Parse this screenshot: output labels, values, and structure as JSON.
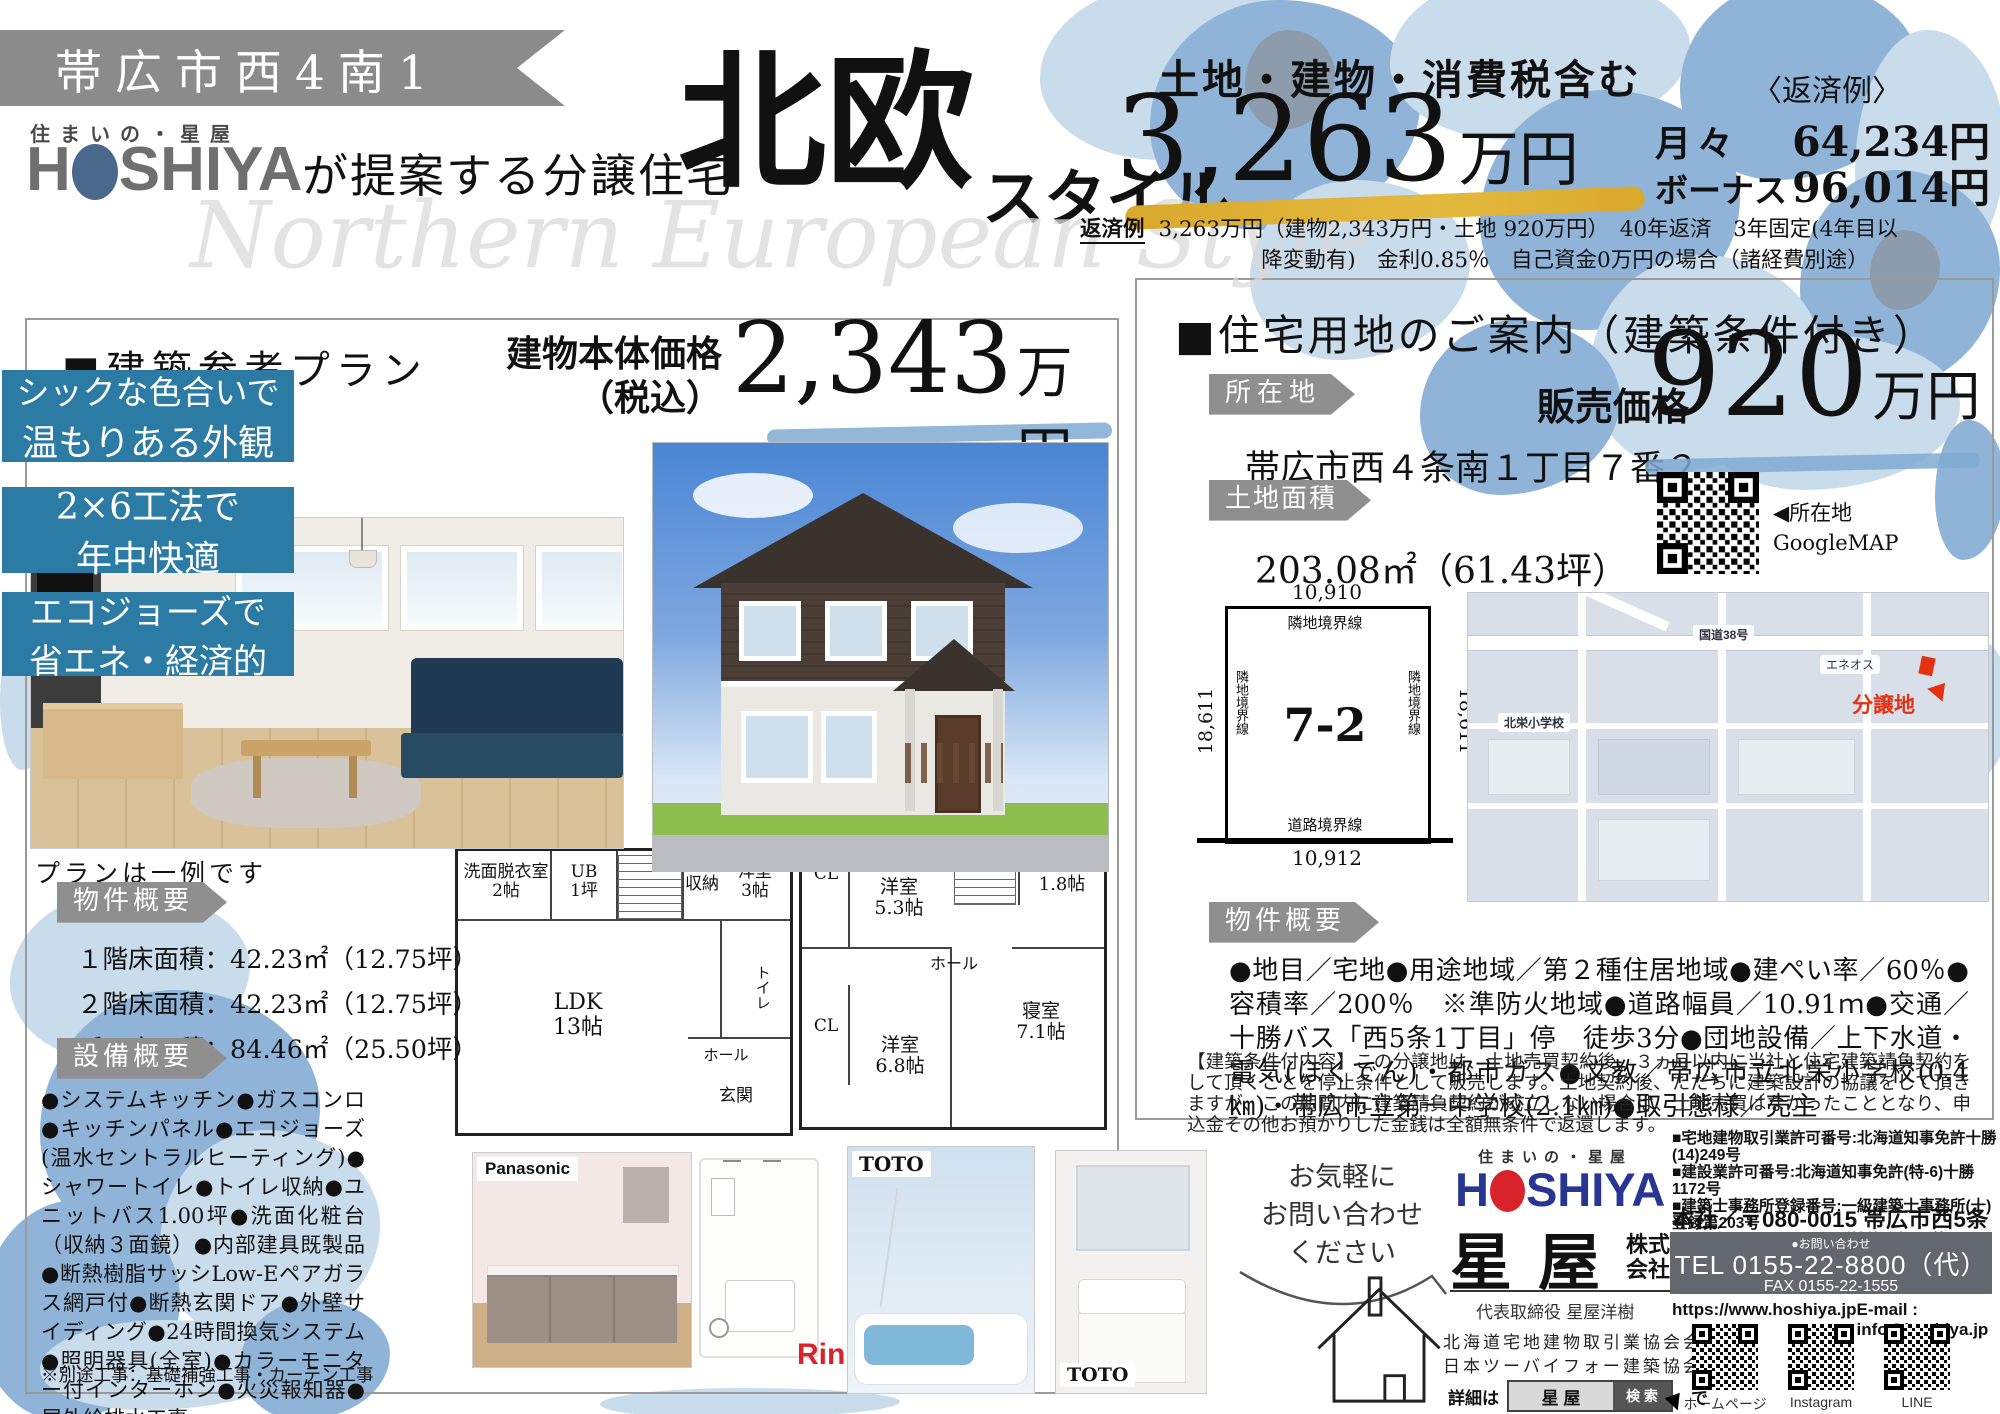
{
  "page": {
    "watermark": "Northern European Style"
  },
  "header": {
    "location_banner": "帯広市西4南1",
    "brand_small": "住まいの・星屋",
    "logo_h": "H",
    "logo_rest": "SHIYA",
    "tagline": "が提案する分譲住宅",
    "style_main": "北欧",
    "style_sub": "スタイル",
    "tax_note": "土地・建物・消費税含む",
    "total_price": "3,263",
    "total_price_unit": "万円",
    "repayment_title": "〈返済例〉",
    "monthly_label": "月々",
    "monthly_value": "64,234円",
    "bonus_label": "ボーナス",
    "bonus_value": "96,014円",
    "fineprint_label": "返済例",
    "fineprint_line1": "3,263万円（建物2,343万円・土地 920万円）　40年返済　3年固定(4年目以",
    "fineprint_line2": "降変動有)　金利0.85％　自己資金0万円の場合（諸経費別途）"
  },
  "plan_panel": {
    "title": "■建築参考プラン",
    "price_label_1": "建物本体価格",
    "price_label_2": "（税込）",
    "price_value": "2,343",
    "price_unit": "万円",
    "features": [
      {
        "line1": "シックな色合いで",
        "line2": "温もりある外観"
      },
      {
        "line1": "2×6工法で",
        "line2": "年中快適"
      },
      {
        "line1": "エコジョーズで",
        "line2": "省エネ・経済的"
      }
    ],
    "plan_note": "プランは一例です",
    "outline_label": "物件概要",
    "areas": [
      "１階床面積：42.23㎡（12.75坪）",
      "２階床面積：42.23㎡（12.75坪）",
      "延　床面積：84.46㎡（25.50坪）"
    ],
    "equipment_label": "設備概要",
    "equipment_text": "●システムキッチン●ガスコンロ●キッチンパネル●エコジョーズ(温水セントラルヒーティング)●シャワートイレ●トイレ収納●ユニットバス1.00坪●洗面化粧台（収納３面鏡）●内部建具既製品●断熱樹脂サッシLow-Eペアガラス網戸付●断熱玄関ドア●外壁サイディング●24時間換気システム●照明器具(全室)●カラーモニター付インターホン●火災報知器●屋外給排水工事",
    "equipment_note": "※別途工事：基礎補強工事・カーテン工事",
    "fp1": {
      "washroom": "洗面脱衣室",
      "washroom_size": "2帖",
      "ub": "UB",
      "ub_size": "1坪",
      "closet": "収納",
      "room": "洋室",
      "room_size": "3帖",
      "ldk": "LDK",
      "ldk_size": "13帖",
      "toilet": "トイレ",
      "hall": "ホール",
      "entrance": "玄関"
    },
    "fp2": {
      "cl_a": "CL",
      "room_a": "洋室",
      "room_a_size": "5.3帖",
      "wcl": "WCL",
      "wcl_size": "1.8帖",
      "hall": "ホール",
      "cl_b": "CL",
      "room_b": "洋室",
      "room_b_size": "6.8帖",
      "bedroom": "寝室",
      "bedroom_size": "7.1帖"
    },
    "brands": {
      "kitchen": "Panasonic",
      "boiler": "Rinnai",
      "bath": "TOTO",
      "vanity": "TOTO"
    }
  },
  "land_panel": {
    "title": "■住宅用地のご案内（建築条件付き）",
    "location_label": "所在地",
    "address": "帯広市西４条南１丁目７番２",
    "price_label": "販売価格",
    "price_value": "920",
    "price_unit": "万円",
    "area_label": "土地面積",
    "area_value": "203.08㎡（61.43坪）",
    "map_qr_caption1": "◀所在地",
    "map_qr_caption2": "GoogleMAP",
    "lot": {
      "top": "10,910",
      "top_label": "隣地境界線",
      "left": "18,611",
      "left_label": "隣地境界線",
      "right": "18,611",
      "right_label": "隣地境界線",
      "number": "7-2",
      "bottom_label": "道路境界線",
      "bottom": "10,912"
    },
    "map": {
      "route": "国道38号",
      "school": "北栄小学校",
      "site": "分譲地",
      "gas": "エネオス"
    },
    "outline_label": "物件概要",
    "outline_text": "●地目／宅地●用途地域／第２種住居地域●建ぺい率／60％●容積率／200％　※準防火地域●道路幅員／10.91ｍ●交通／十勝バス「西5条1丁目」停　徒歩3分●団地設備／上下水道・電気(ほくでん)・都市ガス●文教／帯広市立北栄小学校(0.4㎞)・帯広市立第一中学校(2.1㎞)●取引態様／売主",
    "conditions_text": "【建築条件付内容】この分譲地は、土地売買契約後、３ヵ月以内に当社と住宅建築請負契約をして頂くことを停止条件として販売します。土地契約後、ただちに建築設計の協議をして頂きますが、この期間内に建築請負契約が成立しない場合は、土地売買はなかったこととなり、申込金その他お預かりした金銭は全額無条件で返還します。"
  },
  "footer": {
    "bubble_line1": "お気軽に",
    "bubble_line2": "お問い合わせ",
    "bubble_line3": "ください",
    "brand_small": "住まいの・星屋",
    "logo_h": "H",
    "logo_rest": "SHIYA",
    "company_name": "星屋",
    "company_suffix_1": "株式",
    "company_suffix_2": "会社",
    "ceo": "代表取締役 星屋洋樹",
    "membership_1": "北海道宅地建物取引業協会会員",
    "membership_2": "日本ツーバイフォー建築協会会員",
    "search_prefix": "詳細は",
    "search_term": "星 屋",
    "search_button": "検 索",
    "search_suffix": "で",
    "licenses": [
      "■宅地建物取引業許可番号:北海道知事免許十勝(14)249号",
      "■建設業許可番号:北海道知事免許(特-6)十勝1172号",
      "■建築士事務所登録番号:一級建築士事務所(十)登録第203号",
      "■不動産コンサルティング技能登録(6)第16424号"
    ],
    "hq": "本社／〒080-0015 帯広市西5条南17丁目11",
    "contact_label": "●お問い合わせ",
    "tel": "TEL 0155-22-8800（代）",
    "fax": "FAX 0155-22-1555",
    "web": "https://www.hoshiya.jp",
    "email": "E-mail : info@hoshiya.jp",
    "qr_labels": [
      "ホームページ",
      "Instagram",
      "LINE"
    ]
  }
}
